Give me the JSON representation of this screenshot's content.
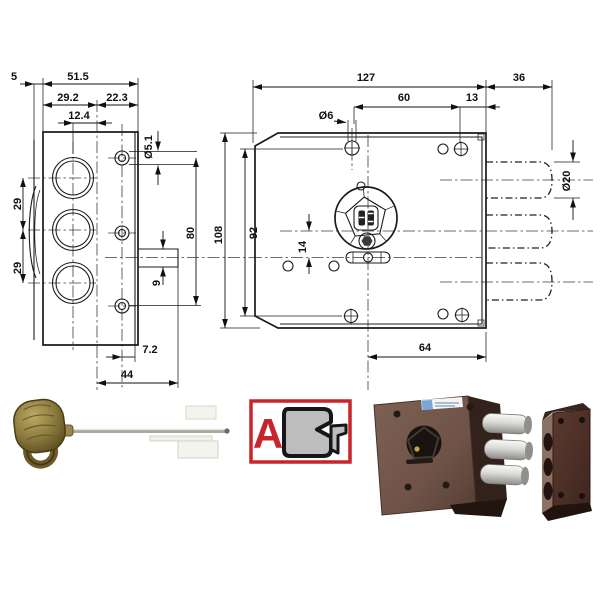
{
  "drawing": {
    "left_view": {
      "dims": {
        "d5": "5",
        "d51_5": "51.5",
        "d29_2": "29.2",
        "d22_3": "22.3",
        "d12_4": "12.4",
        "dia5_1": "Ø5.1",
        "d29_top": "29",
        "d29_bottom": "29",
        "d80": "80",
        "d9": "9",
        "d7_2": "7.2",
        "d44": "44"
      }
    },
    "front_view": {
      "dims": {
        "d127": "127",
        "d36": "36",
        "d60": "60",
        "d13": "13",
        "dia6": "Ø6",
        "d108": "108",
        "d92": "92",
        "d14": "14",
        "dia20": "Ø20",
        "d64": "64"
      }
    }
  },
  "mount_type_icon": {
    "letter": "A"
  },
  "colors": {
    "drawing_line": "#1b1b1b",
    "accent_red": "#c8242b",
    "key_brass": "#8a7a3e",
    "lock_body_brown": "#6f5348",
    "strike_brown": "#4e3028",
    "bolt_chrome": "#ececea"
  }
}
